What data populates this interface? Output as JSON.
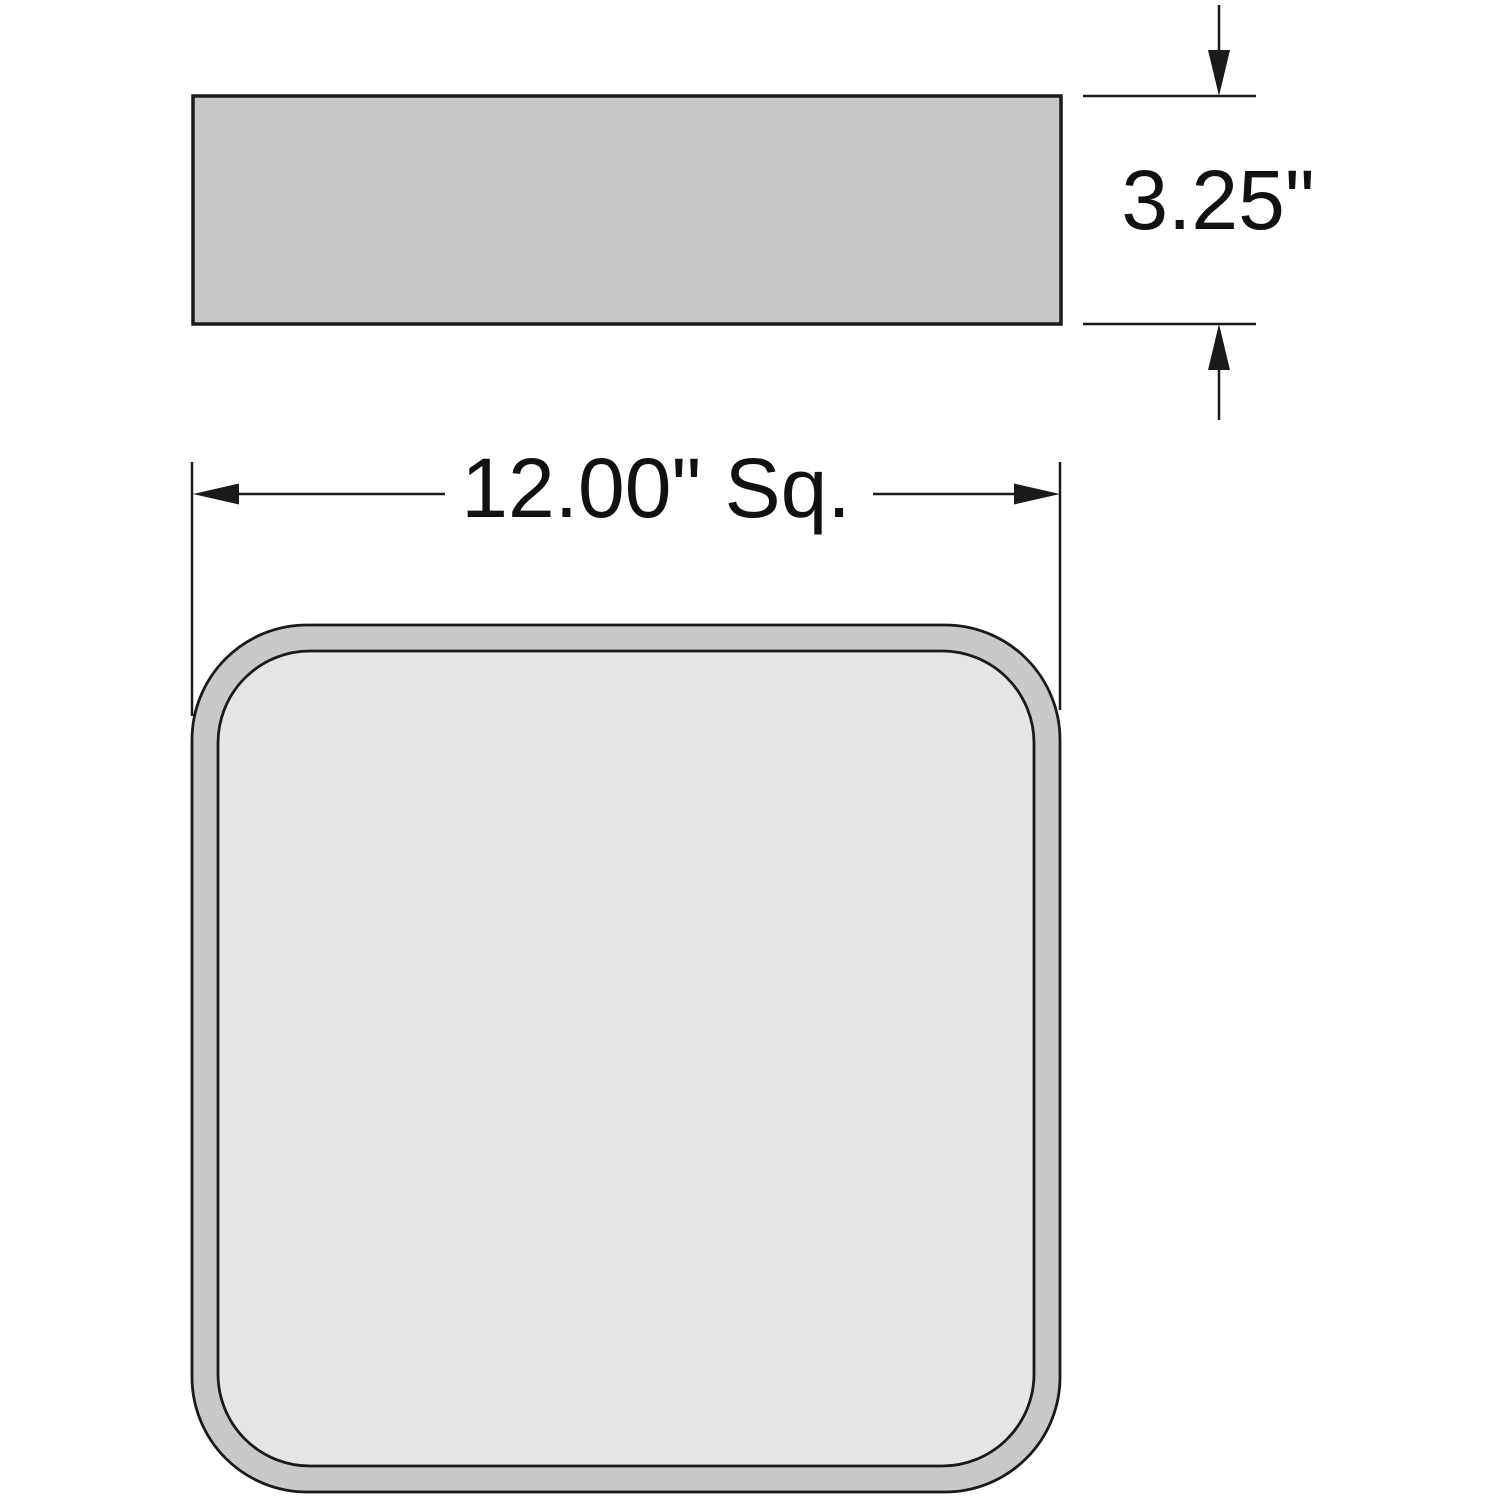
{
  "drawing": {
    "kind": "technical-drawing",
    "background": "#ffffff",
    "line_color": "#1a1a1a",
    "views": {
      "side_view": {
        "fill": "#c7c7c7",
        "stroke": "#1a1a1a"
      },
      "top_view": {
        "outer_fill": "#c9c9c9",
        "inner_fill": "#e5e5e5",
        "stroke": "#1a1a1a"
      }
    },
    "dimensions": {
      "height": {
        "label": "3.25\""
      },
      "width": {
        "label": "12.00\" Sq."
      }
    }
  }
}
